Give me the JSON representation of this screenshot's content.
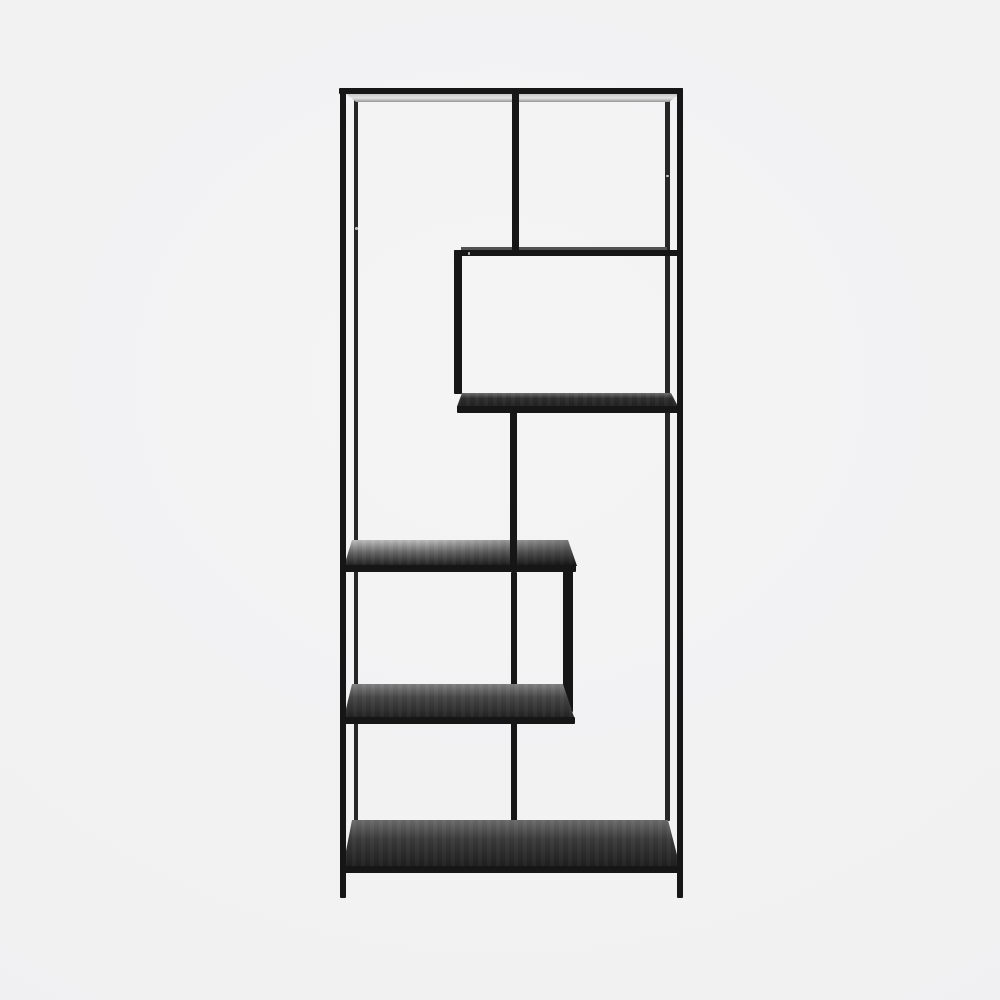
{
  "meta": {
    "type": "product-photo",
    "subject": "Tall black metal asymmetric shelving unit (etagere bookcase) with five staggered shelves, photographed front-on in a studio on a plain light gray background",
    "visible_text": "none"
  },
  "colors": {
    "bg_center": "#f4f4f5",
    "bg_mid": "#f1f1f2",
    "bg_edge": "#ededee",
    "frame": "#161616",
    "frame_back": "#262626",
    "frame_faint": "#515151",
    "glass_a": "#bfbfbf",
    "glass_b": "#e2e2e2",
    "glass_edge": "#979797",
    "wood2_a": "#6e6e6e",
    "wood2_b": "#2e2e2e",
    "wood2_c": "#212121",
    "wood3_a": "#bcbcbc",
    "wood3_b": "#6a6a6a",
    "wood3_c": "#1d1d1d",
    "wood4_a": "#808080",
    "wood4_b": "#474747",
    "wood4_c": "#232323",
    "wood5_a": "#6b6b6b",
    "wood5_b": "#3a3a3a",
    "wood5_c": "#1f1f1f",
    "dot": "#e0e0e0"
  }
}
